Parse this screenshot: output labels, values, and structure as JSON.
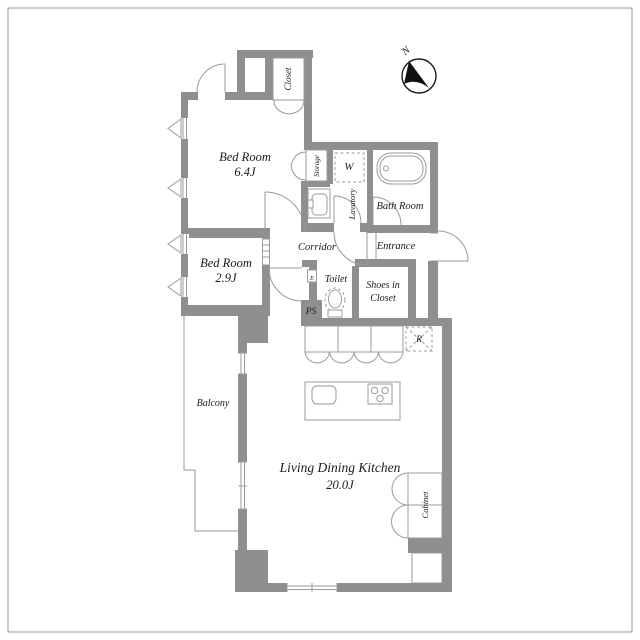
{
  "title": "Apartment floor plan",
  "compass": {
    "north_label": "N"
  },
  "rooms": {
    "bedroom1": {
      "name": "Bed Room",
      "size": "6.4J"
    },
    "bedroom2": {
      "name": "Bed Room",
      "size": "2.9J"
    },
    "ldk": {
      "name": "Living Dining Kitchen",
      "size": "20.0J"
    },
    "closet": {
      "name": "Closet"
    },
    "storage": {
      "name": "Storage"
    },
    "lavatory": {
      "name": "Lavatory"
    },
    "bathroom": {
      "name": "Bath Room"
    },
    "corridor": {
      "name": "Corridor"
    },
    "entrance": {
      "name": "Entrance"
    },
    "toilet": {
      "name": "Toilet"
    },
    "shoes_closet": {
      "line1": "Shoes in",
      "line2": "Closet"
    },
    "balcony": {
      "name": "Balcony"
    },
    "cabinet": {
      "name": "Cabinet"
    }
  },
  "markers": {
    "washing_machine": "W",
    "refrigerator": "R",
    "pipe_space": "PS",
    "electrical": "E"
  },
  "colors": {
    "wall": "#8f8f8f",
    "line": "#9b9b9b",
    "text": "#1a1a1a",
    "background": "#ffffff"
  }
}
